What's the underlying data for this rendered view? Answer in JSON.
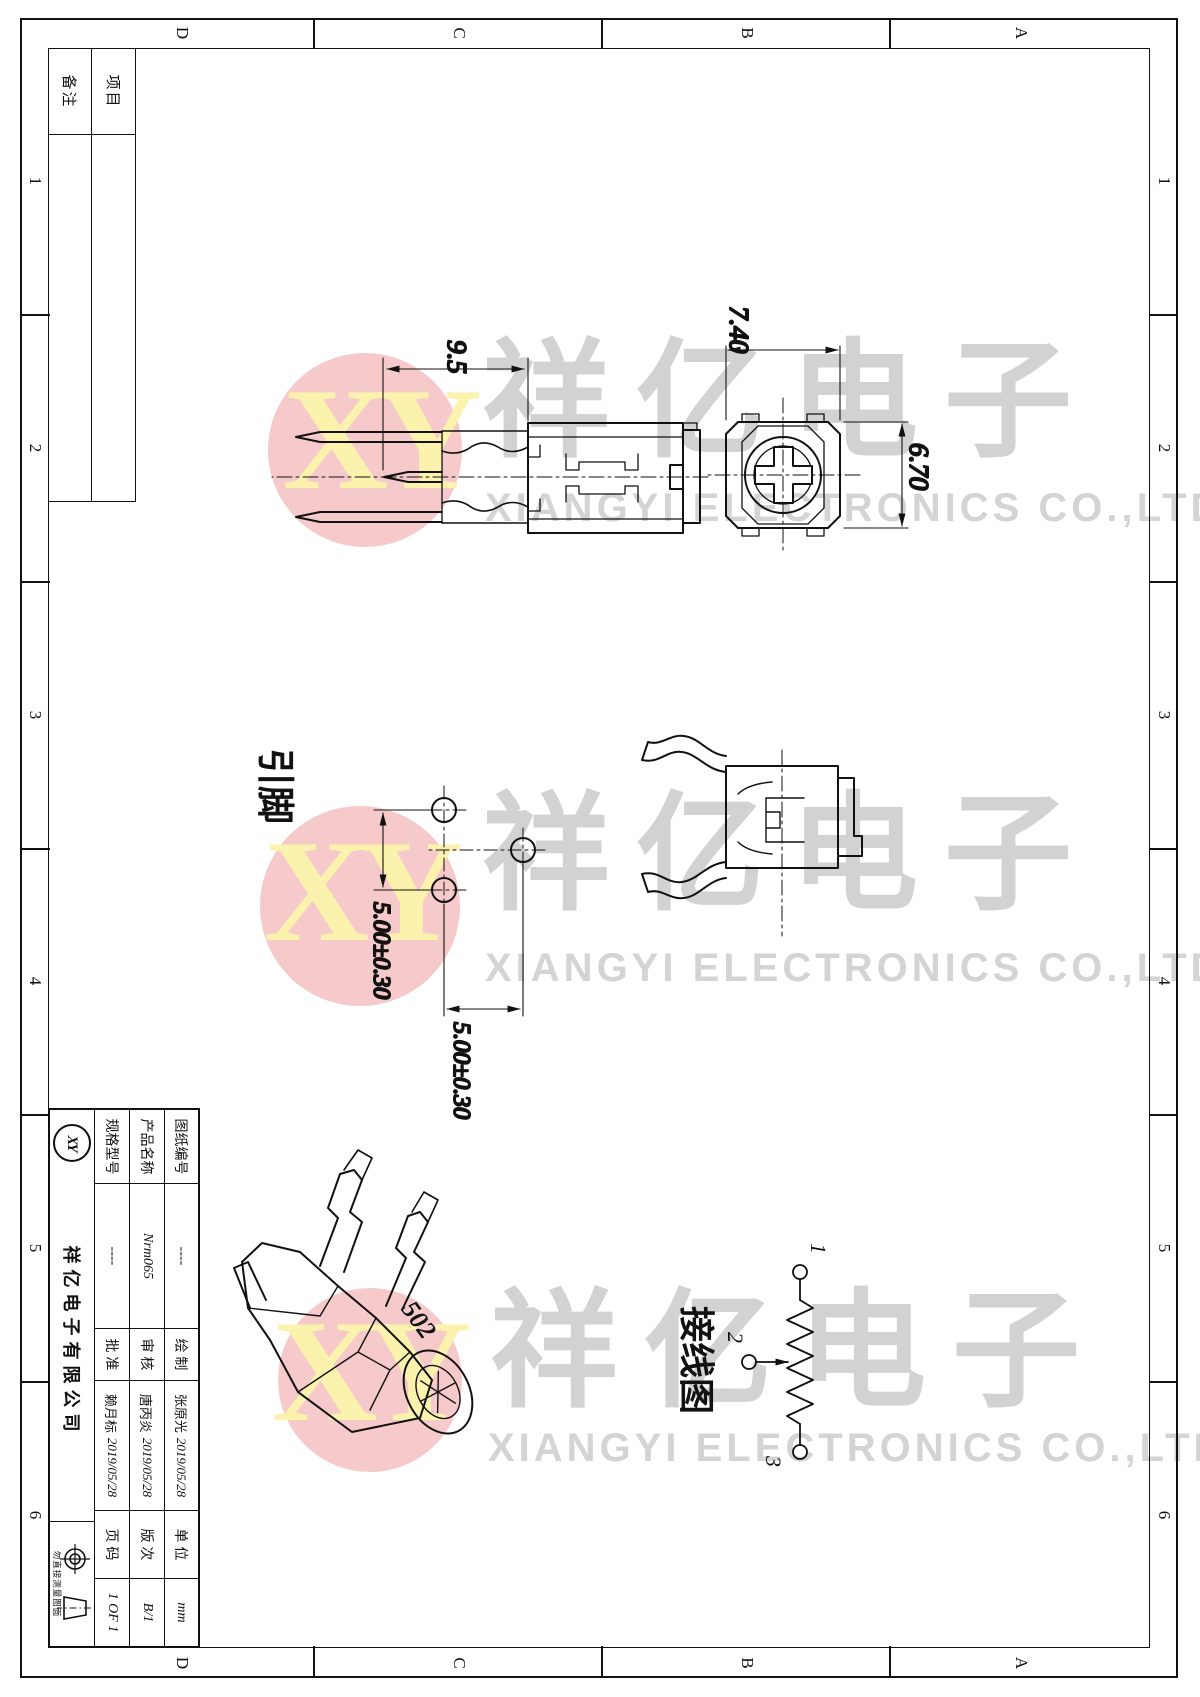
{
  "frame": {
    "cols": [
      "1",
      "2",
      "3",
      "4",
      "5",
      "6"
    ],
    "rows": [
      "A",
      "B",
      "C",
      "D"
    ]
  },
  "notes": {
    "row1": "项目",
    "row2": "备注"
  },
  "title_block": {
    "rows": [
      {
        "label": "图纸编号",
        "value": "----",
        "sign": "绘 制",
        "name": "张原光",
        "date": "2019/05/28",
        "meta": "单 位",
        "meta_value": "mm"
      },
      {
        "label": "产品名称",
        "value": "Nrm065",
        "sign": "审 核",
        "name": "唐丙炎",
        "date": "2019/05/28",
        "meta": "版 次",
        "meta_value": "B/1"
      },
      {
        "label": "规格型号",
        "value": "----",
        "sign": "批 准",
        "name": "赖月标",
        "date": "2019/05/28",
        "meta": "页 码",
        "meta_value": "1 OF 1"
      }
    ],
    "company": "祥亿电子有限公司",
    "logo": "XY",
    "stamp_note": "勿直接测量图面"
  },
  "dims": {
    "front_height": "9.5",
    "top_width": "6.70",
    "top_height": "7.40",
    "pin_pitch_h": "5.00±0.30",
    "pin_pitch_v": "5.00±0.30"
  },
  "labels": {
    "pins": "引脚",
    "wiring": "接线图",
    "marking": "502",
    "t1": "1",
    "t2": "2",
    "t3": "3"
  },
  "watermark": {
    "monogram": "XY",
    "cn": "祥亿电子",
    "en": "XIANGYI ELECTRONICS CO.,LTD",
    "circle_color": "#f6caca",
    "monogram_color": "#fbf2ad",
    "text_color": "#d2d2d2"
  }
}
